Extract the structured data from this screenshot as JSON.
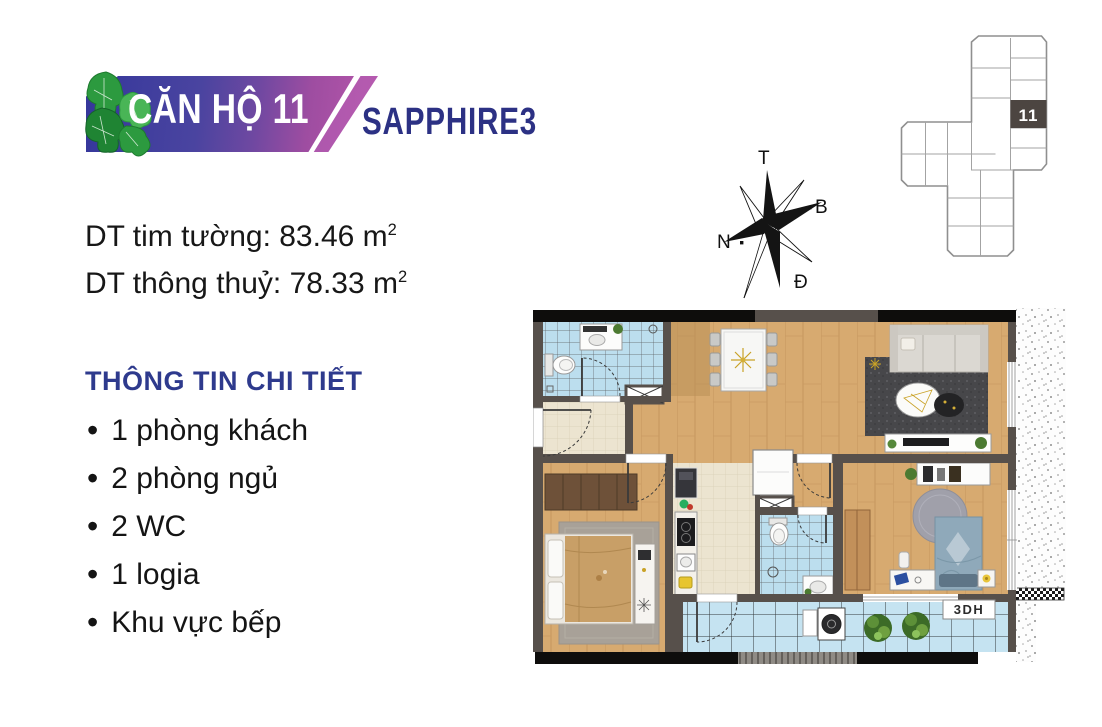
{
  "header": {
    "title": "CĂN HỘ 11",
    "project": "SAPPHIRE3"
  },
  "areas": [
    {
      "label": "DT tim tường:",
      "value": "83.46",
      "unit": "m",
      "exp": "2"
    },
    {
      "label": "DT thông thuỷ:",
      "value": "78.33",
      "unit": "m",
      "exp": "2"
    }
  ],
  "details": {
    "heading": "THÔNG TIN CHI TIẾT",
    "items": [
      "1 phòng khách",
      "2 phòng ngủ",
      "2 WC",
      "1 logia",
      "Khu vực bếp"
    ]
  },
  "compass": {
    "top": "T",
    "right": "B",
    "left": "N",
    "bottom": "Đ"
  },
  "key_plan": {
    "unit_number": "11"
  },
  "floor_plan": {
    "watermark": "3DH"
  },
  "colors": {
    "banner_start": "#35379b",
    "banner_end": "#b054a8",
    "project_navy": "#2c3184",
    "heading_blue": "#2e3a8d",
    "wall_gray": "#57504b",
    "wood": "#d7aa70",
    "tile_blue": "#bcdeee",
    "tile_cream": "#ece4d0",
    "leaf_green": "#2c9a3f"
  }
}
